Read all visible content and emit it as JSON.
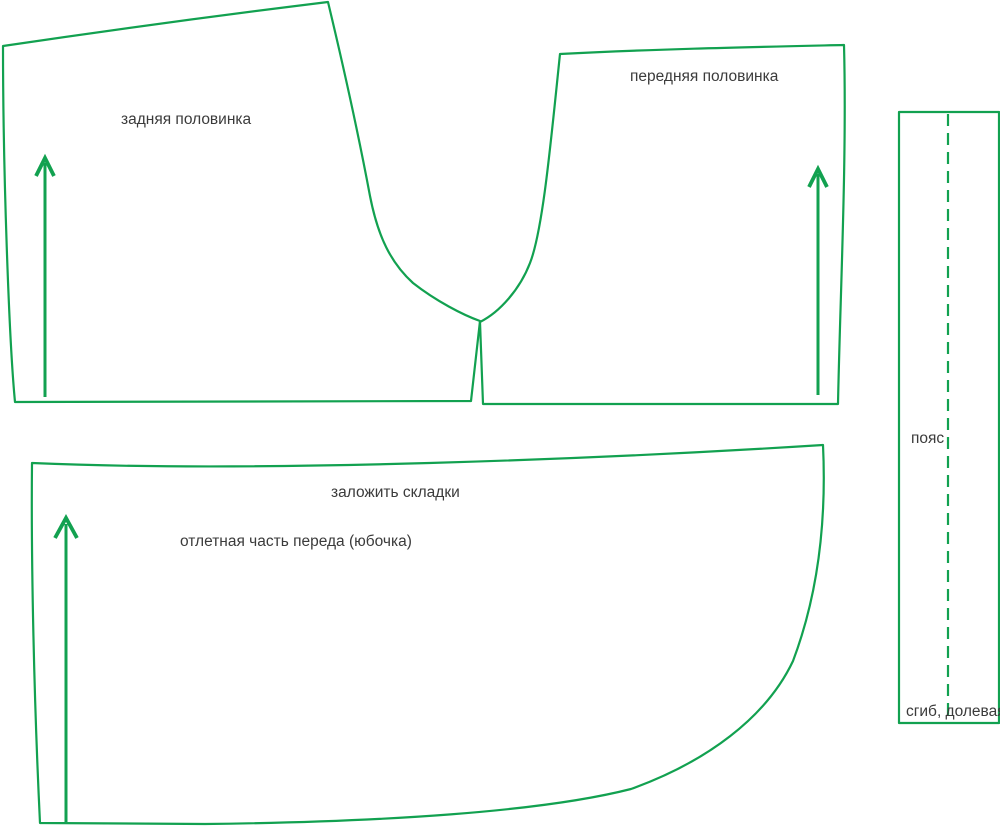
{
  "diagram_title": "sewing-pattern-pieces",
  "colors": {
    "outline_green": "#12A150",
    "label_text": "#3B3B3B",
    "background": "#FFFFFF"
  },
  "pieces": {
    "back_half": {
      "label": "задняя половинка",
      "grainline_icon": "up-arrow"
    },
    "front_half": {
      "label": "передняя половинка",
      "grainline_icon": "up-arrow"
    },
    "skirt": {
      "note": "заложить складки",
      "label": "отлетная часть переда (юбочка)",
      "grainline_icon": "up-arrow"
    },
    "waistband": {
      "label": "пояс",
      "note": "сгиб, долевая",
      "fold_line_style": "dashed"
    }
  }
}
